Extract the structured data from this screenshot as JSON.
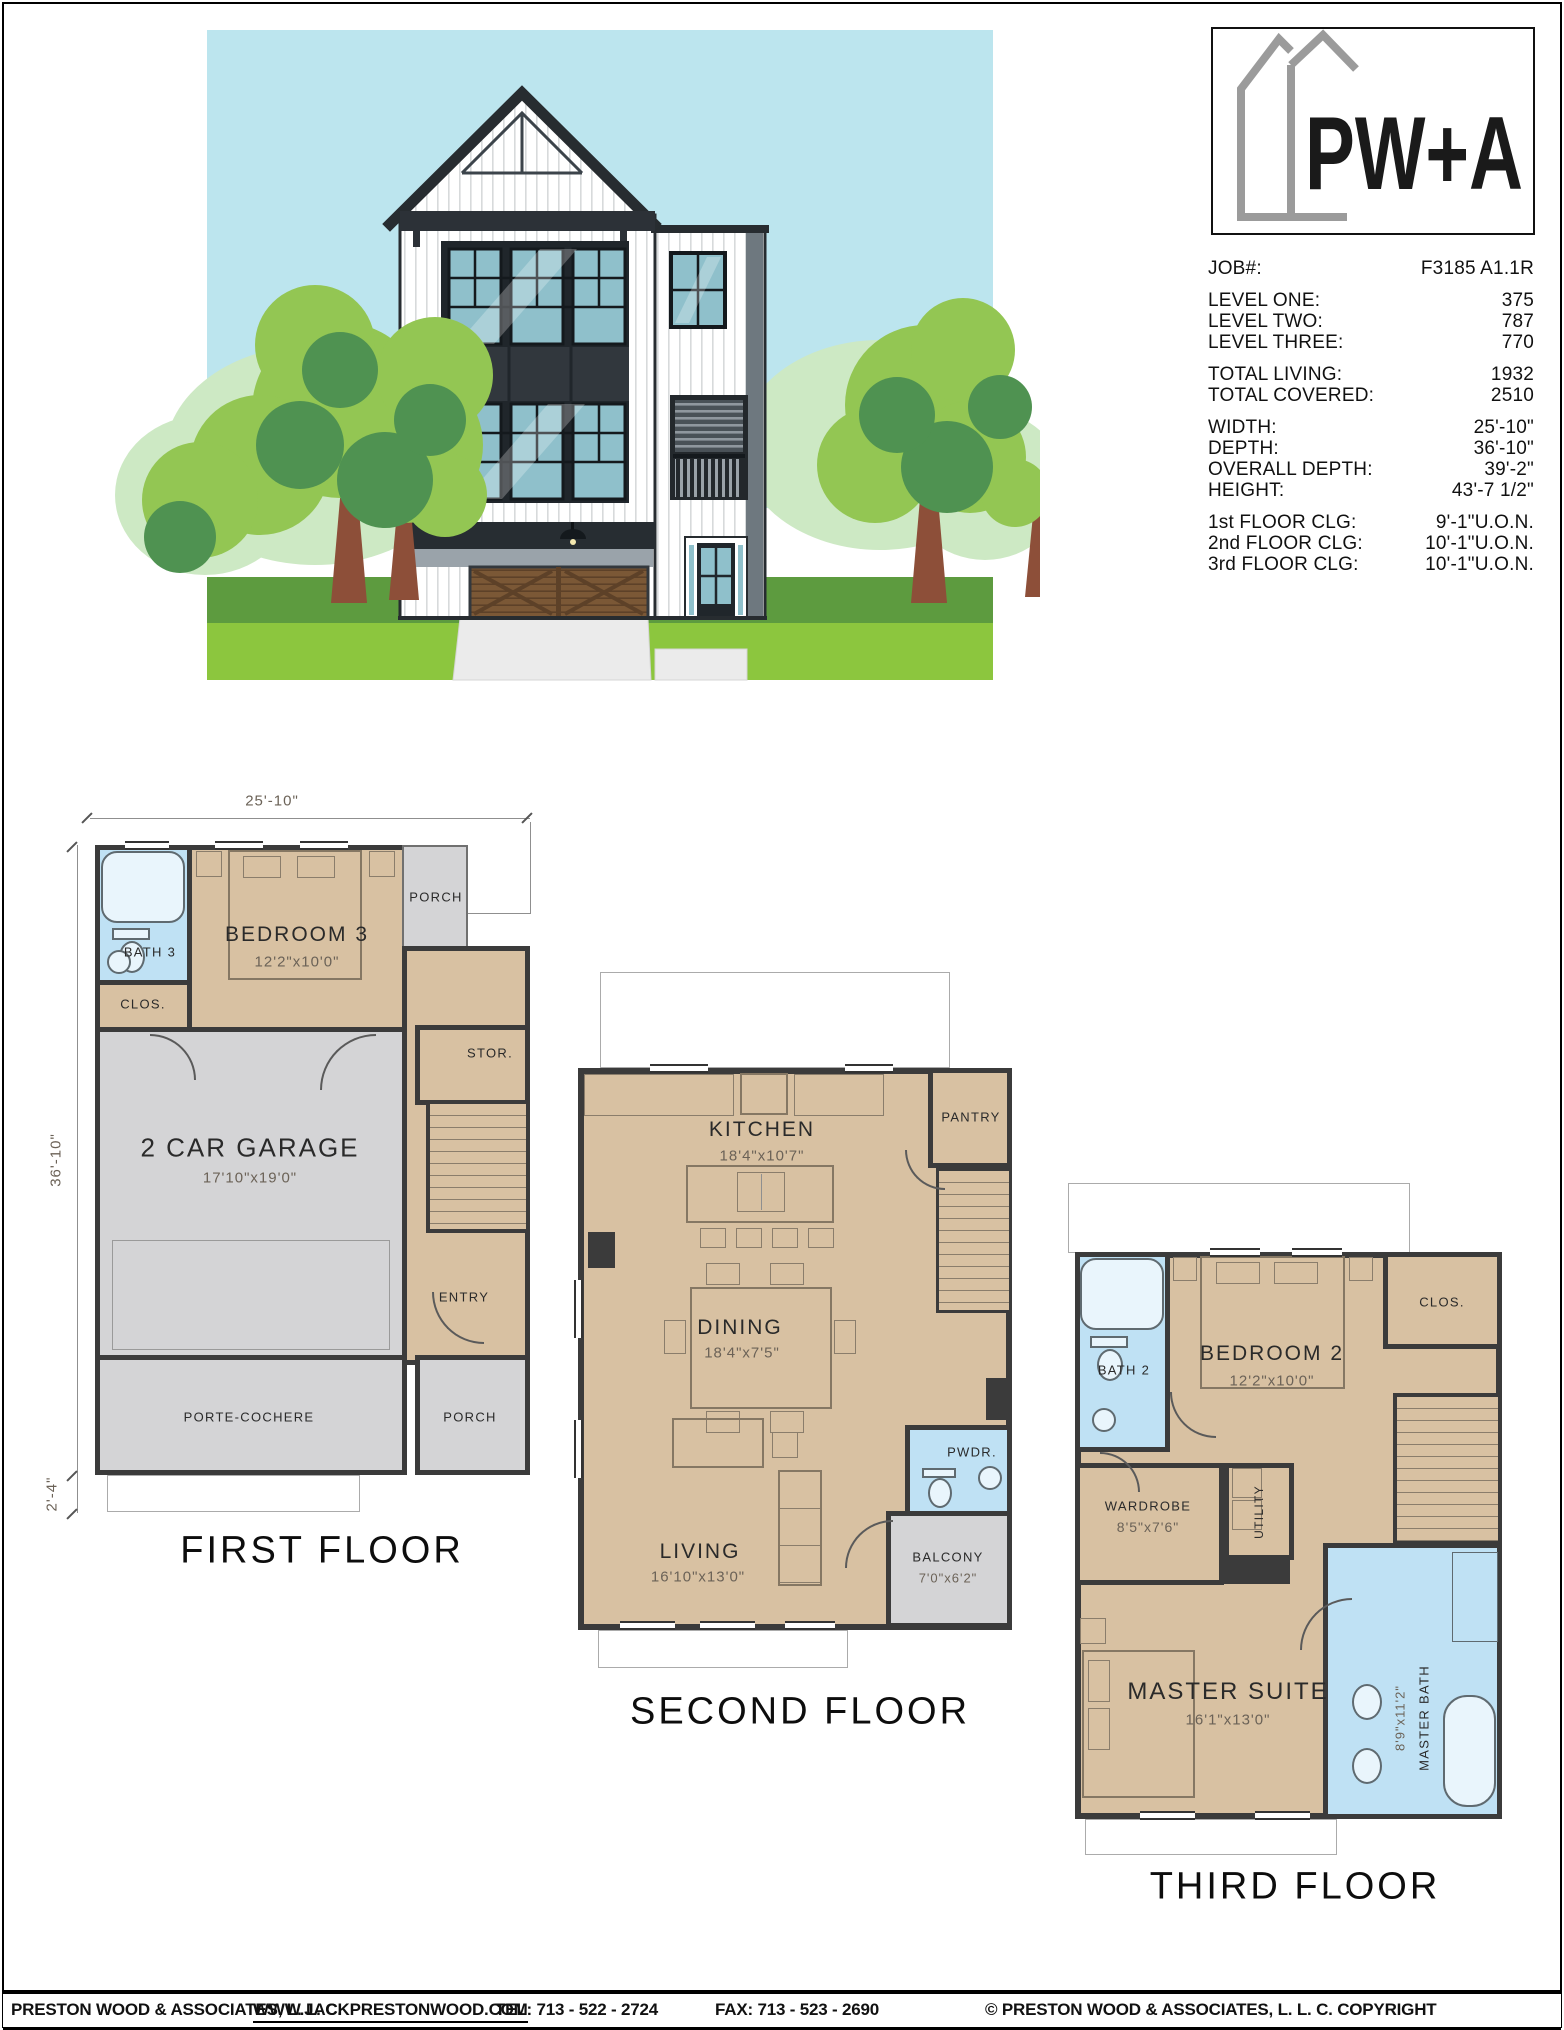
{
  "logo": {
    "text": "PW+A"
  },
  "info": {
    "job_label": "JOB#:",
    "job_value": "F3185 A1.1R",
    "rows_a": [
      {
        "label": "LEVEL ONE:",
        "value": "375"
      },
      {
        "label": "LEVEL TWO:",
        "value": "787"
      },
      {
        "label": "LEVEL THREE:",
        "value": "770"
      }
    ],
    "rows_b": [
      {
        "label": "TOTAL LIVING:",
        "value": "1932"
      },
      {
        "label": "TOTAL COVERED:",
        "value": "2510"
      }
    ],
    "rows_c": [
      {
        "label": "WIDTH:",
        "value": "25'-10\""
      },
      {
        "label": "DEPTH:",
        "value": "36'-10\""
      },
      {
        "label": "OVERALL DEPTH:",
        "value": "39'-2\""
      },
      {
        "label": "HEIGHT:",
        "value": "43'-7 1/2\""
      }
    ],
    "rows_d": [
      {
        "label": "1st FLOOR CLG:",
        "value": "9'-1\"U.O.N."
      },
      {
        "label": "2nd FLOOR CLG:",
        "value": "10'-1\"U.O.N."
      },
      {
        "label": "3rd FLOOR CLG:",
        "value": "10'-1\"U.O.N."
      }
    ]
  },
  "first_floor": {
    "title": "FIRST FLOOR",
    "dim_top": "25'-10\"",
    "dim_left": "36'-10\"",
    "dim_left2": "2'-4\"",
    "rooms": {
      "bath": "BATH 3",
      "clos": "CLOS.",
      "bedroom": "BEDROOM 3",
      "bedroom_size": "12'2\"x10'0\"",
      "porch_top": "PORCH",
      "stor": "STOR.",
      "garage": "2 CAR GARAGE",
      "garage_size": "17'10\"x19'0\"",
      "entry": "ENTRY",
      "porte_cochere": "PORTE-COCHERE",
      "porch_bottom": "PORCH"
    }
  },
  "second_floor": {
    "title": "SECOND FLOOR",
    "rooms": {
      "kitchen": "KITCHEN",
      "kitchen_size": "18'4\"x10'7\"",
      "pantry": "PANTRY",
      "dining": "DINING",
      "dining_size": "18'4\"x7'5\"",
      "pwdr": "PWDR.",
      "living": "LIVING",
      "living_size": "16'10\"x13'0\"",
      "balcony": "BALCONY",
      "balcony_size": "7'0\"x6'2\""
    }
  },
  "third_floor": {
    "title": "THIRD FLOOR",
    "rooms": {
      "bath": "BATH 2",
      "bedroom": "BEDROOM 2",
      "bedroom_size": "12'2\"x10'0\"",
      "clos": "CLOS.",
      "wardrobe": "WARDROBE",
      "wardrobe_size": "8'5\"x7'6\"",
      "utility": "UTILITY",
      "master": "MASTER SUITE",
      "master_size": "16'1\"x13'0\"",
      "master_bath": "MASTER BATH",
      "master_bath_size": "8'9\"x11'2\""
    }
  },
  "footer": {
    "company": "PRESTON WOOD & ASSOCIATES, L. L. C.",
    "website": "WWW.JACKPRESTONWOOD.COM",
    "tel": "TEL: 713 - 522 - 2724",
    "fax": "FAX: 713 - 523 - 2690",
    "copyright": "© PRESTON WOOD & ASSOCIATES, L. L. C.  COPYRIGHT"
  },
  "colors": {
    "plan_floor_tan": "#d8c1a2",
    "plan_bath_blue": "#bfe1f4",
    "plan_porch_gray": "#d4d4d6",
    "plan_wall": "#3b3b3b",
    "sky": "#bce5ee",
    "tree_green": "#93c653",
    "tree_dark_green": "#4f9251",
    "lawn_green": "#8cc63e",
    "logo_gray": "#9b9b9b"
  }
}
